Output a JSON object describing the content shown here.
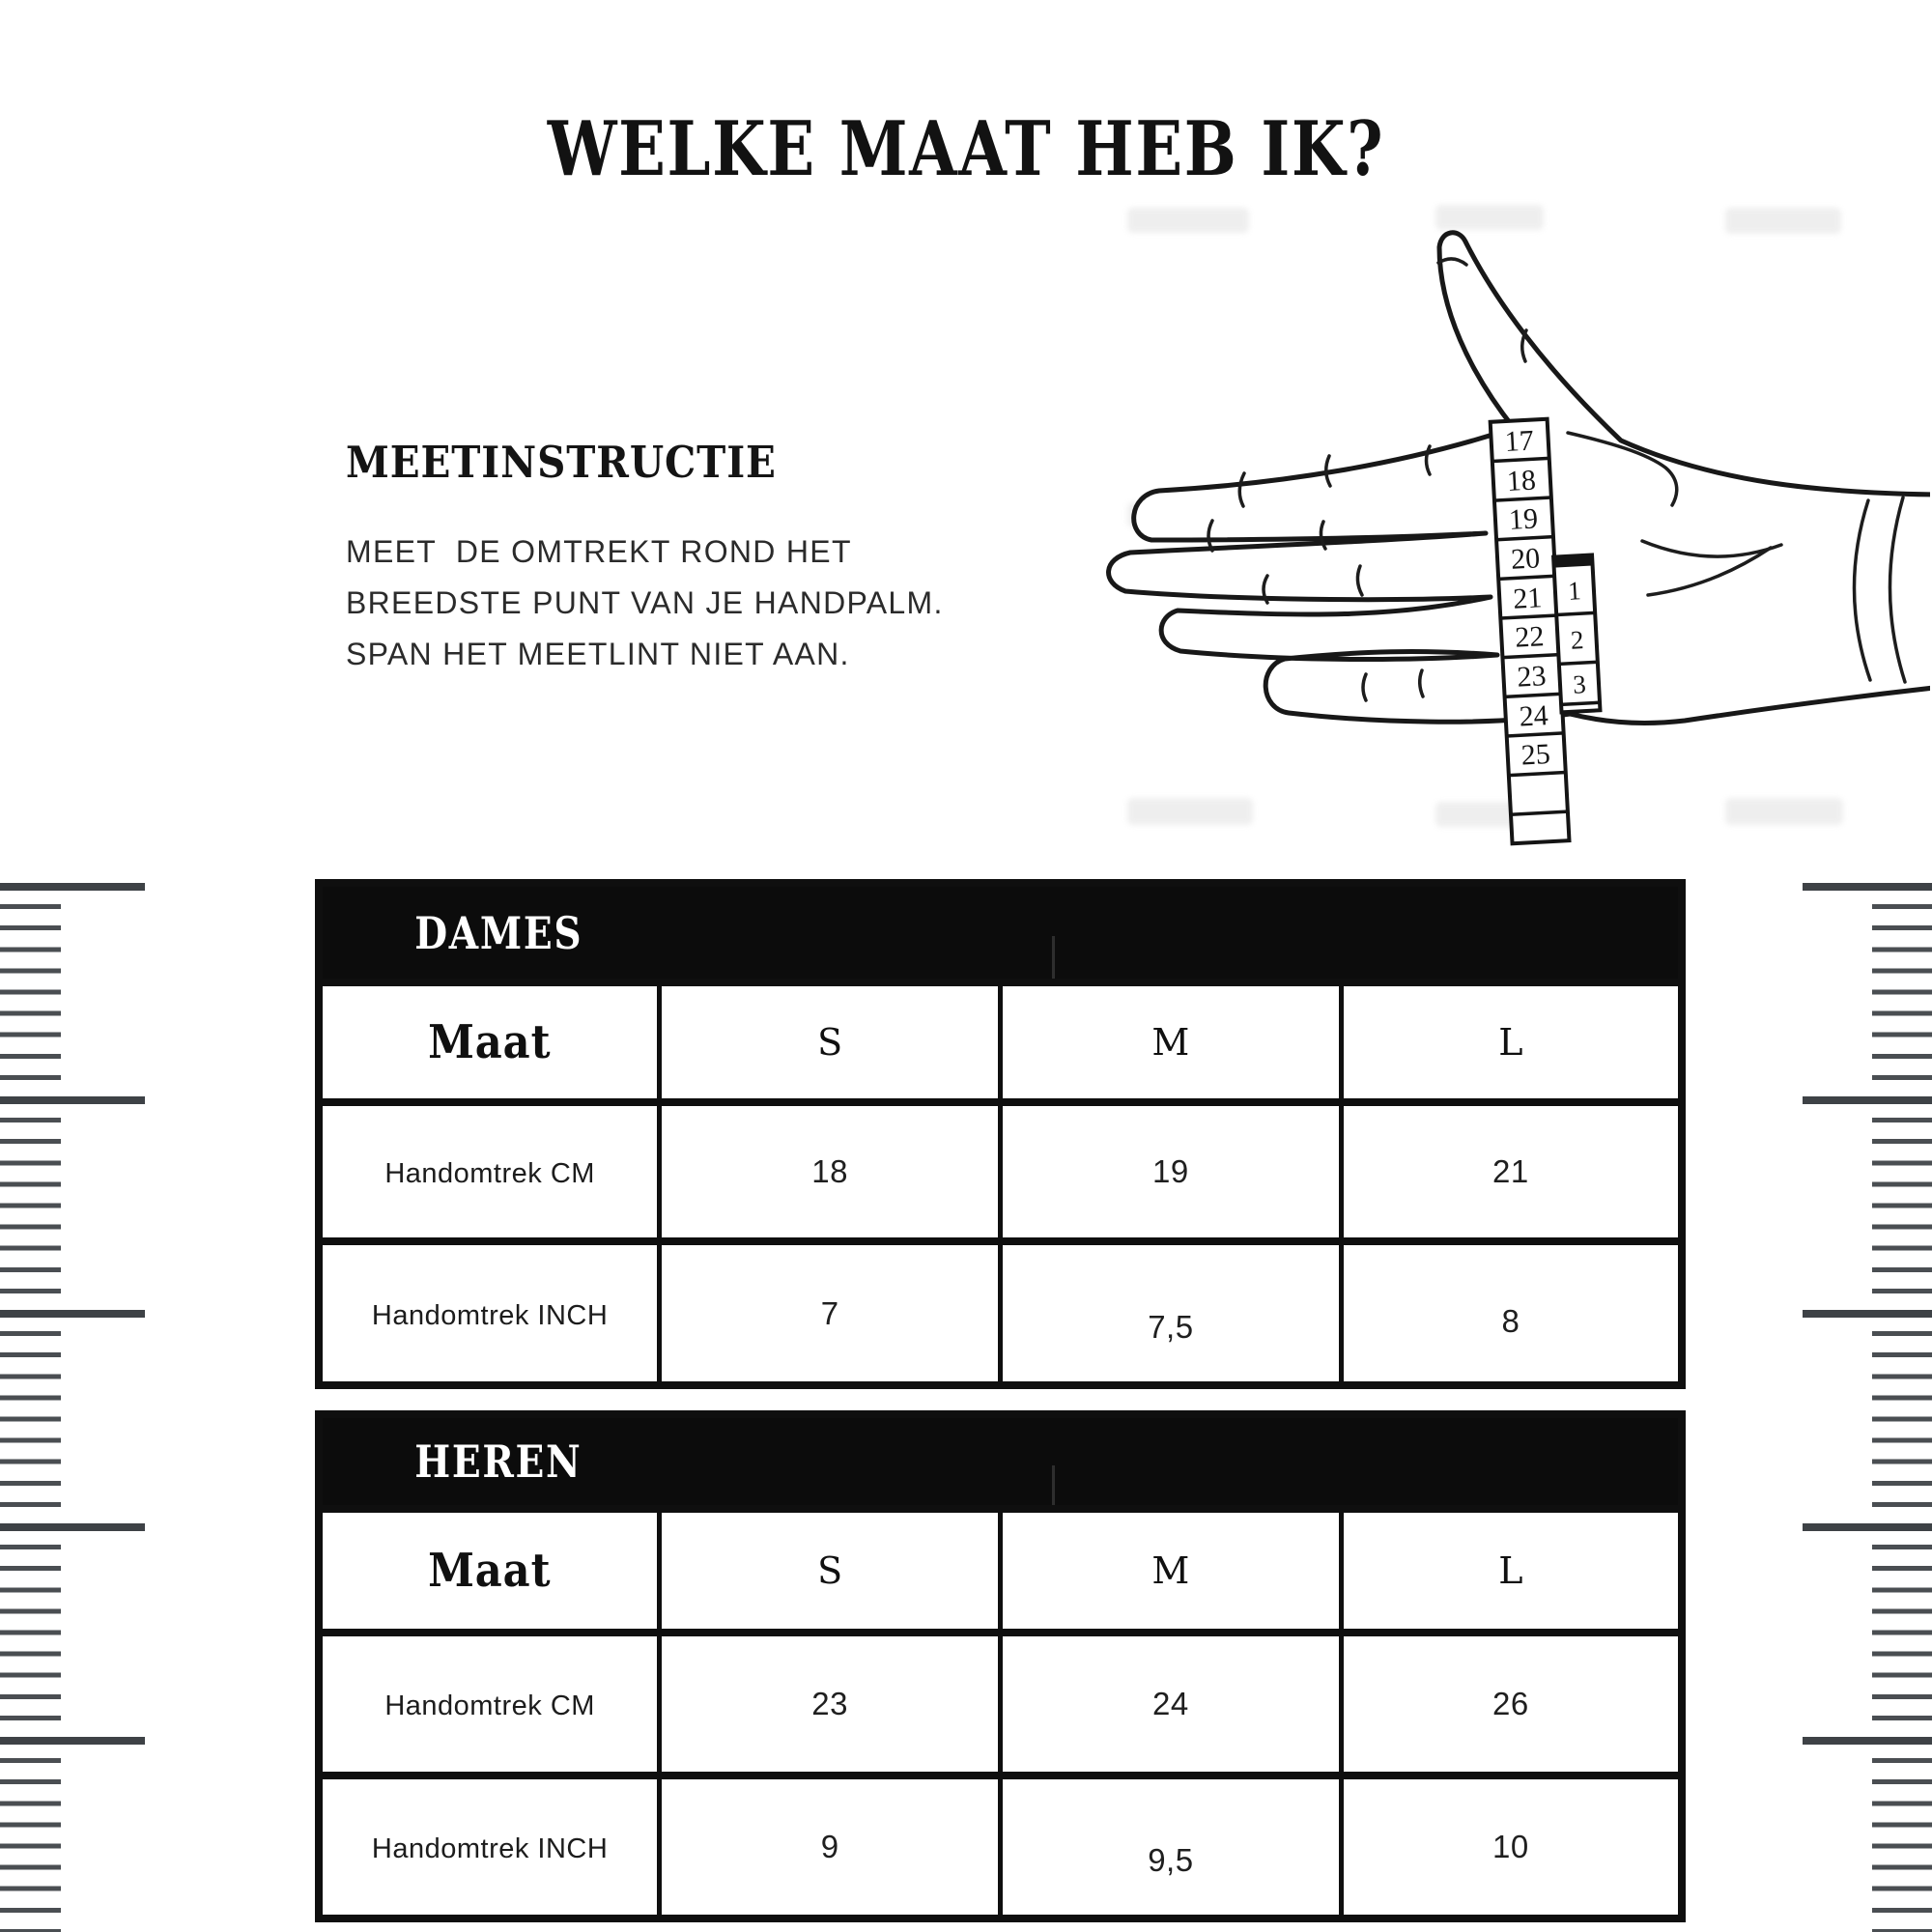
{
  "page": {
    "title": "WELKE MAAT HEB IK?"
  },
  "instruction": {
    "heading": "MEETINSTRUCTIE",
    "lines": [
      "MEET  DE OMTREKT ROND HET",
      "BREEDSTE PUNT VAN JE HANDPALM.",
      "SPAN HET MEETLINT NIET AAN."
    ]
  },
  "illustration": {
    "tape_main": [
      "17",
      "18",
      "19",
      "20",
      "21",
      "22",
      "23",
      "24",
      "25"
    ],
    "tape_side": [
      "1",
      "2",
      "3"
    ]
  },
  "tables": {
    "dames": {
      "title": "DAMES",
      "header": [
        "Maat",
        "S",
        "M",
        "L"
      ],
      "rows": [
        {
          "label": "Handomtrek CM",
          "values": [
            "18",
            "19",
            "21"
          ]
        },
        {
          "label": "Handomtrek INCH",
          "values": [
            "7",
            "7,5",
            "8"
          ]
        }
      ]
    },
    "heren": {
      "title": "HEREN",
      "header": [
        "Maat",
        "S",
        "M",
        "L"
      ],
      "rows": [
        {
          "label": "Handomtrek CM",
          "values": [
            "23",
            "24",
            "26"
          ]
        },
        {
          "label": "Handomtrek INCH",
          "values": [
            "9",
            "9,5",
            "10"
          ]
        }
      ]
    }
  },
  "colors": {
    "band": "#0c0c0c",
    "ink": "#161616",
    "ruler_gray": "#45494d"
  }
}
